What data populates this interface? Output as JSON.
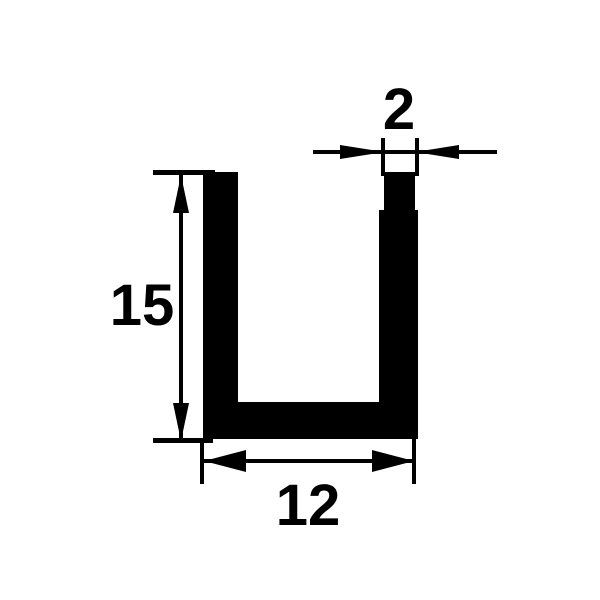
{
  "labels": {
    "height": "15",
    "width": "12",
    "thickness": "2"
  },
  "colors": {
    "ink": "#000000",
    "background": "#ffffff"
  }
}
